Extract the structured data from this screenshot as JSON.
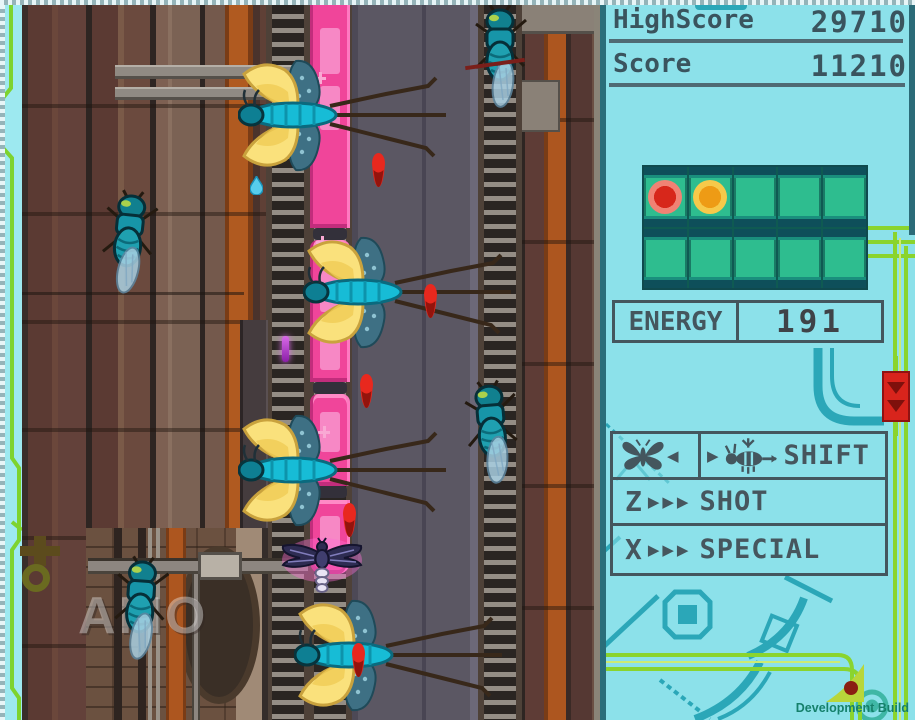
{
  "title": "Shoot-em-up gameplay screen",
  "hud": {
    "highscore": {
      "label": "HighScore",
      "value": "29710"
    },
    "score": {
      "label": "Score",
      "value": "11210"
    },
    "energy": {
      "label": "ENERGY",
      "value": "191"
    },
    "energy_grid": {
      "rows": 2,
      "columns": 5,
      "total_cells": 10,
      "indicators": [
        {
          "cell": 1,
          "name": "red-indicator",
          "inner_color": "#d7271b",
          "outer_color": "#f08274"
        },
        {
          "cell": 2,
          "name": "orange-indicator",
          "inner_color": "#ee9b15",
          "outer_color": "#f6c94a"
        }
      ]
    },
    "controls": {
      "shift": {
        "left_icon": "butterfly-icon",
        "right_icon": "bee-icon",
        "left_arrow": "◀",
        "right_arrow": "▶",
        "label": "SHIFT"
      },
      "shot": {
        "key": "Z",
        "arrows": "▶▶▶",
        "label": "SHOT"
      },
      "special": {
        "key": "X",
        "arrows": "▶▶▶",
        "label": "SPECIAL"
      }
    },
    "dev_build_label": "Development Build"
  },
  "game": {
    "watermark_text": "AMO",
    "entities": {
      "enemy_bees": 4,
      "enemy_flies": 4,
      "player_ship": 1,
      "red_bullets": 5,
      "train_cars": 4
    }
  },
  "colors": {
    "hud_background": "#8ce1ea",
    "hud_text": "#44565e",
    "energy_cell_green": "#2ebd8f",
    "train_pink": "#f0459a",
    "circuit_teal": "#2ba7b8",
    "circuit_green": "#8ad42e",
    "bullet_red": "#e8281e",
    "road_gray": "#5b5763"
  }
}
